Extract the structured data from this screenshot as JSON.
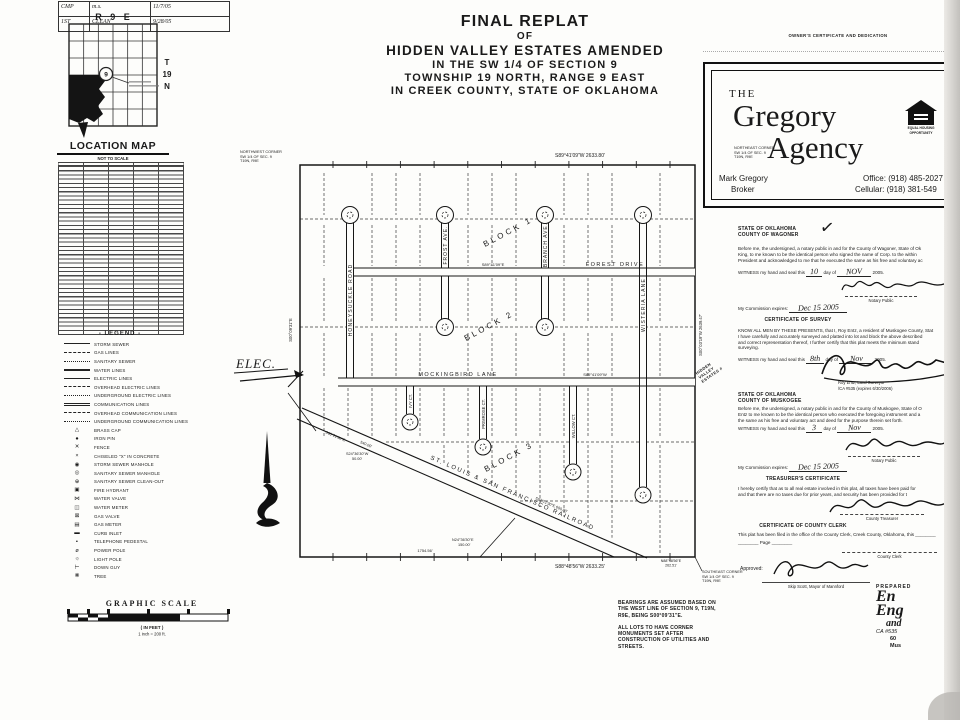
{
  "title_block": {
    "lines": [
      "FINAL REPLAT",
      "OF",
      "HIDDEN VALLEY ESTATES AMENDED",
      "IN THE SW 1/4 OF SECTION 9",
      "TOWNSHIP 19 NORTH, RANGE 9 EAST",
      "IN CREEK COUNTY, STATE OF OKLAHOMA"
    ]
  },
  "revision_table": {
    "rows": [
      [
        "CMP",
        "m.s.",
        "11/7/05"
      ],
      [
        "1ST",
        "CLEAN",
        "9/28/05"
      ]
    ]
  },
  "location_map": {
    "range": "R 9 E",
    "township_lines": [
      "T",
      "19",
      "N"
    ],
    "section": "9",
    "title": "LOCATION MAP",
    "subtitle": "NOT TO SCALE"
  },
  "legend": {
    "title": "- LEGEND -",
    "line_items": [
      "STORM SEWER",
      "GAS LINES",
      "SANITARY SEWER",
      "WATER LINES",
      "ELECTRIC LINES",
      "OVERHEAD ELECTRIC LINES",
      "UNDERGROUND ELECTRIC LINES",
      "COMMUNICATION LINES",
      "OVERHEAD COMMUNICATION LINES",
      "UNDERGROUND COMMUNICATION LINES"
    ],
    "symbol_items": [
      {
        "sym": "△",
        "label": "BRASS CAP"
      },
      {
        "sym": "●",
        "label": "IRON PIN"
      },
      {
        "sym": "✕",
        "label": "FENCE"
      },
      {
        "sym": "×",
        "label": "CHISELED \"X\" IN CONCRETE"
      },
      {
        "sym": "◉",
        "label": "STORM SEWER MANHOLE"
      },
      {
        "sym": "◎",
        "label": "SANITARY SEWER MANHOLE"
      },
      {
        "sym": "⊕",
        "label": "SANITARY SEWER CLEAN-OUT"
      },
      {
        "sym": "▣",
        "label": "FIRE HYDRANT"
      },
      {
        "sym": "⋈",
        "label": "WATER VALVE"
      },
      {
        "sym": "◫",
        "label": "WATER METER"
      },
      {
        "sym": "⊠",
        "label": "GAS VALVE"
      },
      {
        "sym": "▤",
        "label": "GAS METER"
      },
      {
        "sym": "▬",
        "label": "CURB INLET"
      },
      {
        "sym": "▪",
        "label": "TELEPHONE PEDESTAL"
      },
      {
        "sym": "ø",
        "label": "POWER POLE"
      },
      {
        "sym": "☼",
        "label": "LIGHT POLE"
      },
      {
        "sym": "⊢",
        "label": "DOWN GUY"
      },
      {
        "sym": "❋",
        "label": "TREE"
      }
    ]
  },
  "agency": {
    "heading": "OWNER'S CERTIFICATE AND DEDICATION",
    "the": "THE",
    "name1": "Gregory",
    "name2": "Agency",
    "contact_name": "Mark Gregory",
    "contact_role": "Broker",
    "office": "Office: (918) 485-2027",
    "cellular": "Cellular: (918) 381-549",
    "eho_line1": "EQUAL HOUSING",
    "eho_line2": "OPPORTUNITY"
  },
  "plat": {
    "streets": {
      "honeysuckle": "HONEYSUCKLE ROAD",
      "frost": "FROST AVE.",
      "branch": "BRANCH AVE.",
      "wisteria": "WISTERIA LANE",
      "forest": "FOREST DRIVE",
      "mockingbird": "MOCKINGBIRD LANE",
      "ivy": "IVY CT.",
      "primrose": "PRIMROSE CT.",
      "willow": "WILLOW CT."
    },
    "blocks": [
      "BLOCK 1",
      "BLOCK 2",
      "BLOCK 3"
    ],
    "railroad": "ST. LOUIS & SAN FRANCISCO RAILROAD",
    "bearings": {
      "north": "S89°41'09\"W    2633.80'",
      "south": "S88°48'56\"W    2633.25'",
      "east": "S00°03'19\"W  2639.47'",
      "west": "S00°09'31\"E",
      "forest": "S89°41'09\"E",
      "mockingbird": "S89°41'09\"W",
      "south_partial": "1754.56'",
      "rail_a": "S63°21'30\"E",
      "rail_b": "540.00'",
      "rail_c": "S63°21'30\"E  600.00'",
      "hwy_1": "S24°36'30\"W",
      "hwy_2": "50.00'",
      "spur_1": "N24°36'30\"E",
      "spur_2": "150.00'",
      "se_1": "N88°48'56\"E",
      "se_2": "262.51'"
    },
    "corners": {
      "nw": "NORTHWEST CORNER\nSW 1/4 OF SEC. 9\nT19N, R9E",
      "ne": "NORTHEAST CORNER\nSW 1/4 OF SEC. 9\nT19N, R9E",
      "se": "SOUTHEAST CORNER\nSW 1/4 OF SEC. 9\nT19N, R9E"
    },
    "elec_note": "ELEC."
  },
  "certs": {
    "checkmark": "✓",
    "stamp": "HIDDEN\nVALLEY\nESTATES #",
    "wagoner": {
      "state": "STATE OF OKLAHOMA",
      "county": "COUNTY OF WAGONER",
      "lines": [
        "Before me, the undersigned, a notary public in and for the County of Wagoner, State of Ok",
        "King, to me known to be the identical person who signed the name of Corp. to the within",
        "President and acknowledged to me that he executed the same as his free and voluntary ac"
      ],
      "witness_pre": "WITNESS my hand and seal this",
      "day": "10",
      "mid": "day of",
      "month": "NOV",
      "year": "2005.",
      "notary": "Notary Public",
      "commission_label": "My Commission expires:",
      "commission_date": "Dec 15 2005"
    },
    "survey": {
      "title": "CERTIFICATE OF SURVEY",
      "lines": [
        "KNOW ALL MEN BY THESE PRESENTS, that I, Roy Entz, a resident of Muskogee County, Stat",
        "I have carefully and accurately surveyed and platted into lot and block the above described",
        "and correct representation thereof, I further certify that this plat meets the minimum stand",
        "surveying."
      ],
      "witness_pre": "WITNESS my hand and seal this",
      "day": "8th",
      "mid": "day of",
      "month": "Nov",
      "year": "2005.",
      "sig_name": "Roy Entz, Land Surveyor",
      "sig_ca": "/CA #535 (expires 6/30/2006)"
    },
    "muskogee": {
      "state": "STATE OF OKLAHOMA",
      "county": "COUNTY OF MUSKOGEE",
      "lines": [
        "Before me, the undersigned, a notary public in and for the County of Muskogee, State of O",
        "Entz to me known to be the identical person who executed the foregoing instrument and a",
        "the same as his free and voluntary act and deed for the purpose therein set forth."
      ],
      "witness_pre": "WITNESS my hand and seal this",
      "day": "3",
      "mid": "day of",
      "month": "Nov",
      "year": "2005.",
      "notary": "Notary Public",
      "commission_label": "My Commission expires:",
      "commission_date": "Dec 15 2005"
    },
    "treasurer": {
      "title": "TREASURER'S CERTIFICATE",
      "lines": [
        "I hereby certify that as to all real estate involved in this plat, all taxes have been paid for",
        "and that there are no taxes due for prior years, and security has been provided for t"
      ],
      "caption": "County Treasurer"
    },
    "clerk": {
      "title": "CERTIFICATE OF COUNTY CLERK",
      "line1": "This plat has been filed in the office of the County Clerk, Creek County, Oklahoma, this ________",
      "line2": "________  Page ________",
      "caption": "County Clerk"
    },
    "approved": {
      "label": "Approved:",
      "caption": "Skip Scott, Mayor of Mannford"
    }
  },
  "notes": {
    "bearings": "BEARINGS ARE ASSUMED BASED ON\nTHE WEST LINE OF SECTION 9, T19N,\nR9E, BEING S00°09'31\"E.",
    "monuments": "ALL LOTS TO HAVE CORNER\nMONUMENTS SET AFTER\nCONSTRUCTION OF UTILITIES AND\nSTREETS."
  },
  "scale_bar": {
    "title": "GRAPHIC SCALE",
    "feet": "( IN FEET )",
    "ratio": "1 inch = 200 ft."
  },
  "preparer": {
    "label": "PREPARED",
    "l1": "En",
    "l2": "Eng",
    "l3": "and",
    "l4": "CA #535",
    "l5": "60",
    "l6": "Mus"
  }
}
